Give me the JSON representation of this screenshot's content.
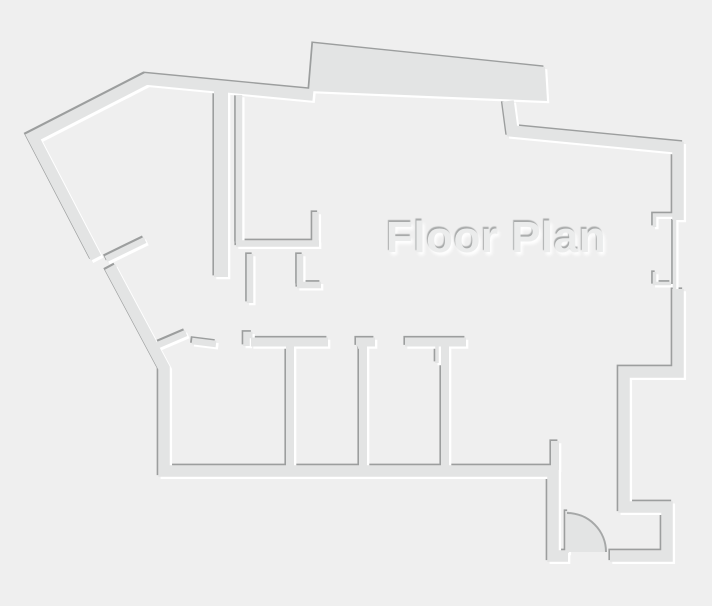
{
  "floor_plan": {
    "title": "Floor Plan"
  },
  "colors": {
    "background": "#efefef",
    "wall_fill": "#e3e4e4",
    "wall_shadow": "#9c9e9e",
    "wall_highlight": "#ffffff",
    "door_arc": "#a6a8a8",
    "title_fill": "#ebecec"
  }
}
